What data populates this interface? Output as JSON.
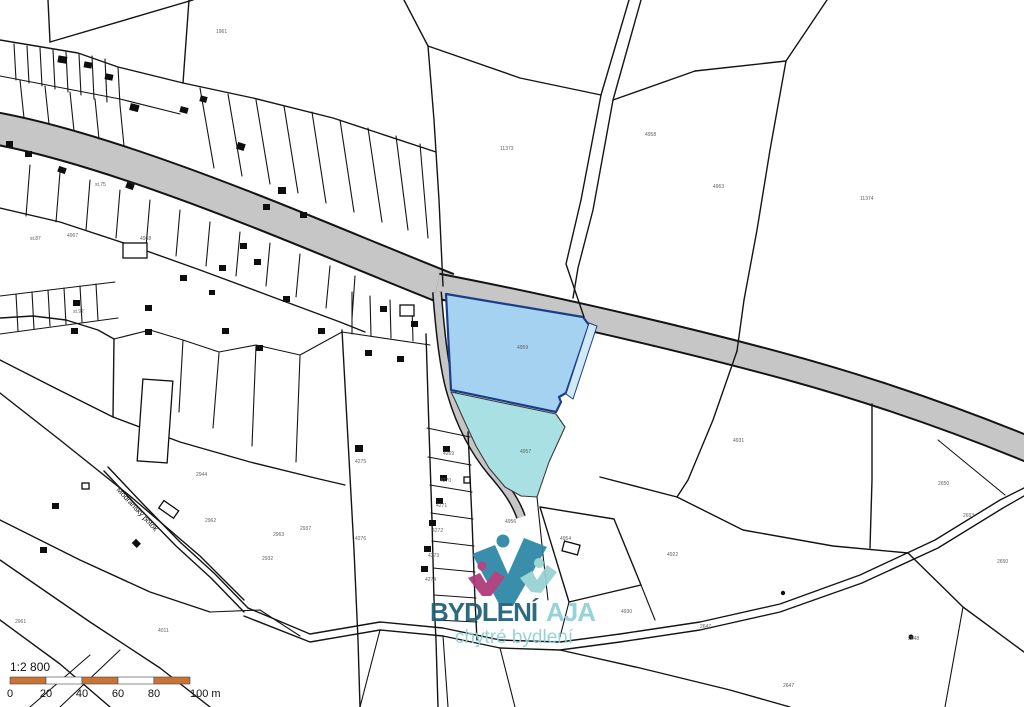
{
  "canvas": {
    "width": 1024,
    "height": 707
  },
  "colors": {
    "background": "#ffffff",
    "parcel_line": "#141414",
    "road_fill": "#c6c6c6",
    "road_edge": "#141414",
    "highlight_primary_fill": "#a6d2f2",
    "highlight_primary_stroke": "#1b3e88",
    "highlight_secondary_fill": "#a9e0e3",
    "scale_segment_orange": "#c97434",
    "logo_dark_teal": "#1d5f78",
    "logo_light_teal": "#8ed0d6",
    "logo_mark_teal": "#2b87a5",
    "logo_mark_magenta": "#ad3779"
  },
  "logo": {
    "title_primary": "BYDLENÍ",
    "title_secondary": "AJA",
    "subtitle": "chytré bydlení"
  },
  "scale_bar": {
    "ratio_label": "1:2 800",
    "tick_labels": [
      "0",
      "20",
      "40",
      "60",
      "80",
      "100 m"
    ],
    "segments": 5,
    "segment_px": 36,
    "origin_x": 10,
    "bar_y": 677,
    "bar_h": 7
  },
  "stream_label": "Modřanský potok",
  "parcel_labels": [
    {
      "x": 216,
      "y": 33,
      "t": "1961"
    },
    {
      "x": 500,
      "y": 150,
      "t": "11373"
    },
    {
      "x": 645,
      "y": 136,
      "t": "4958"
    },
    {
      "x": 713,
      "y": 188,
      "t": "4963"
    },
    {
      "x": 860,
      "y": 200,
      "t": "11374"
    },
    {
      "x": 517,
      "y": 349,
      "t": "4959"
    },
    {
      "x": 520,
      "y": 453,
      "t": "4957"
    },
    {
      "x": 505,
      "y": 523,
      "t": "4956"
    },
    {
      "x": 560,
      "y": 540,
      "t": "4954"
    },
    {
      "x": 355,
      "y": 463,
      "t": "4275"
    },
    {
      "x": 300,
      "y": 530,
      "t": "2937"
    },
    {
      "x": 262,
      "y": 560,
      "t": "2932"
    },
    {
      "x": 205,
      "y": 522,
      "t": "2962"
    },
    {
      "x": 273,
      "y": 536,
      "t": "2963"
    },
    {
      "x": 158,
      "y": 632,
      "t": "4011"
    },
    {
      "x": 15,
      "y": 623,
      "t": "2961"
    },
    {
      "x": 443,
      "y": 455,
      "t": "4269"
    },
    {
      "x": 440,
      "y": 482,
      "t": "4270"
    },
    {
      "x": 436,
      "y": 507,
      "t": "4271"
    },
    {
      "x": 432,
      "y": 532,
      "t": "4272"
    },
    {
      "x": 428,
      "y": 557,
      "t": "4273"
    },
    {
      "x": 425,
      "y": 581,
      "t": "4274"
    },
    {
      "x": 733,
      "y": 442,
      "t": "4931"
    },
    {
      "x": 667,
      "y": 556,
      "t": "4922"
    },
    {
      "x": 938,
      "y": 485,
      "t": "2650"
    },
    {
      "x": 963,
      "y": 517,
      "t": "2653"
    },
    {
      "x": 997,
      "y": 563,
      "t": "2650"
    },
    {
      "x": 908,
      "y": 640,
      "t": "2648"
    },
    {
      "x": 783,
      "y": 687,
      "t": "2647"
    },
    {
      "x": 700,
      "y": 628,
      "t": "2647"
    },
    {
      "x": 621,
      "y": 613,
      "t": "4930"
    },
    {
      "x": 67,
      "y": 237,
      "t": "4967"
    },
    {
      "x": 140,
      "y": 240,
      "t": "4968"
    },
    {
      "x": 95,
      "y": 186,
      "t": "st.75"
    },
    {
      "x": 30,
      "y": 240,
      "t": "st.87"
    },
    {
      "x": 73,
      "y": 313,
      "t": "st.92"
    },
    {
      "x": 196,
      "y": 476,
      "t": "2944"
    },
    {
      "x": 355,
      "y": 540,
      "t": "4276"
    }
  ]
}
